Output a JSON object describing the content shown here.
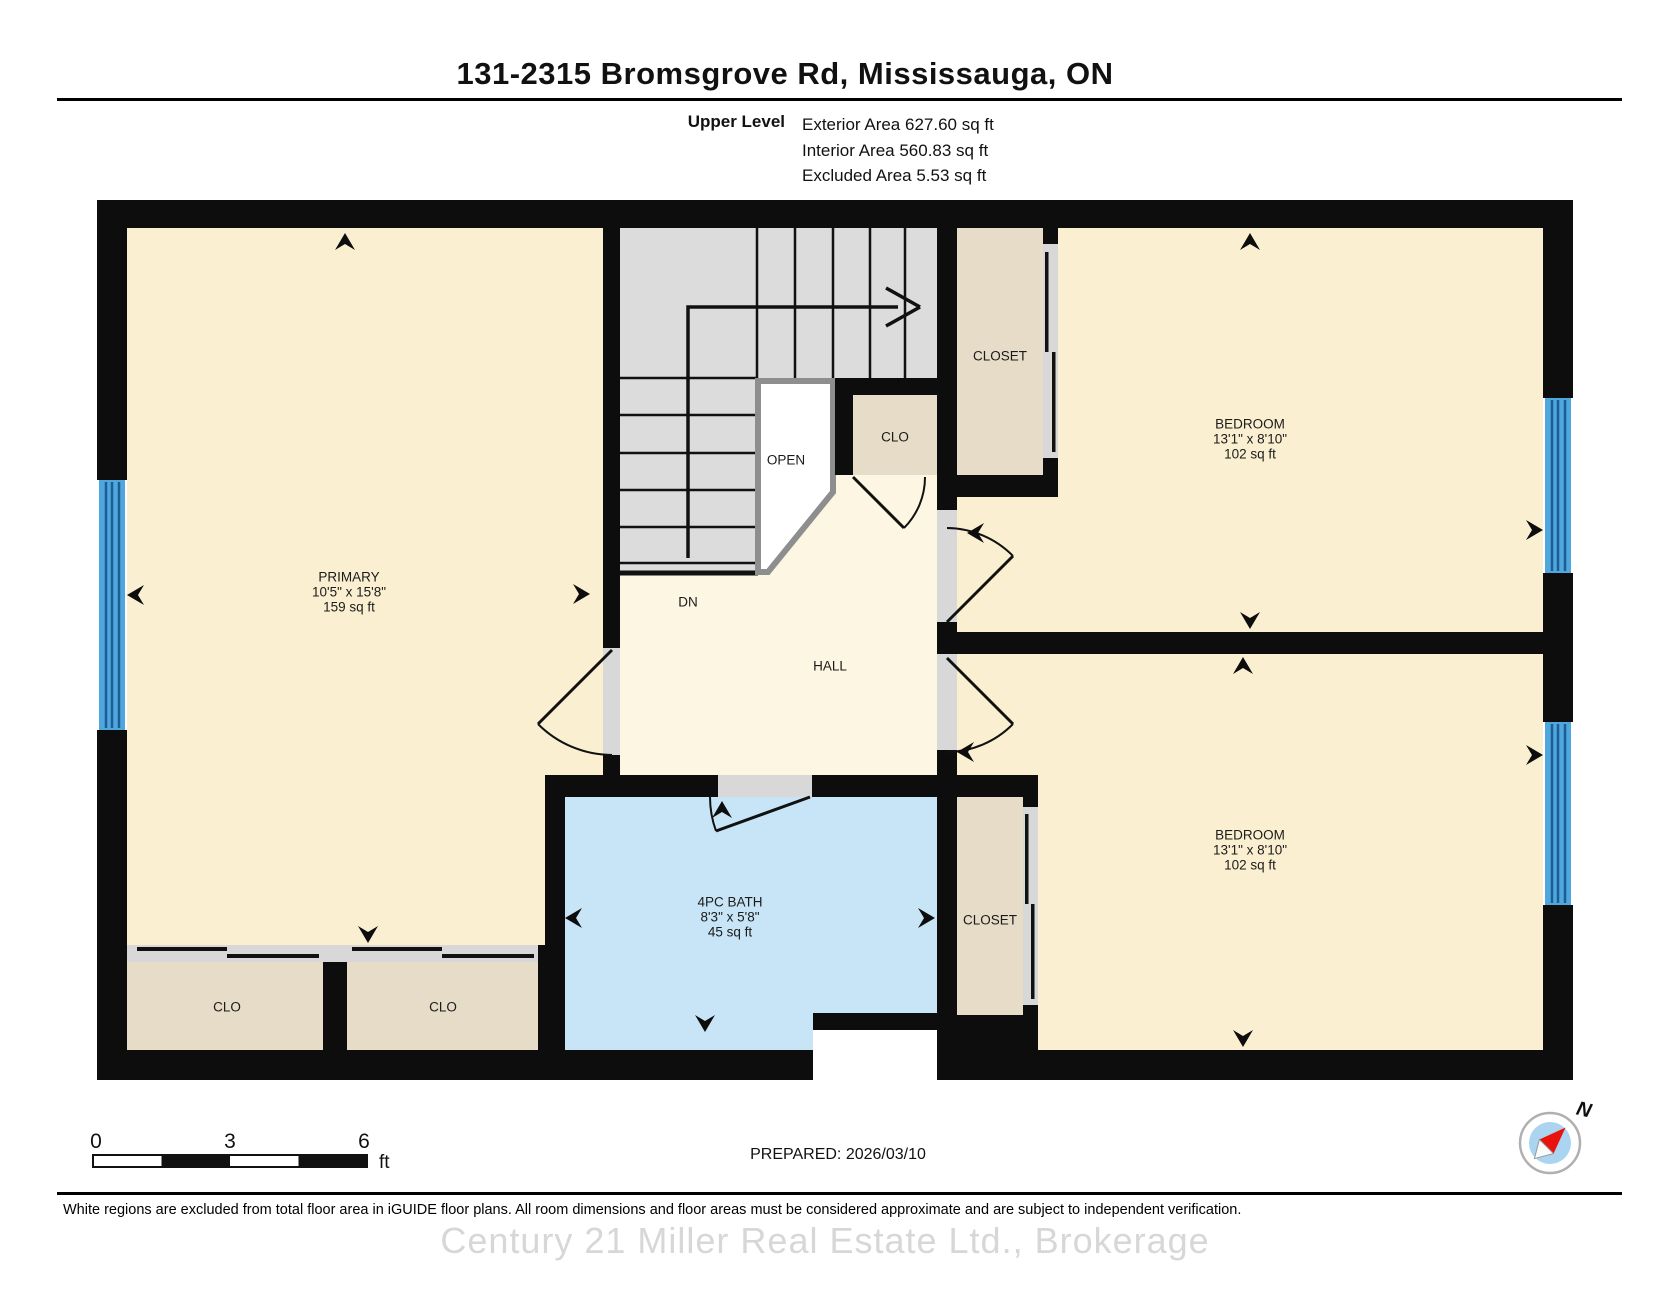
{
  "title": "131-2315 Bromsgrove Rd, Mississauga, ON",
  "level": {
    "name": "Upper Level",
    "exterior": "Exterior Area 627.60 sq ft",
    "interior": "Interior Area 560.83 sq ft",
    "excluded": "Excluded Area 5.53 sq ft"
  },
  "rooms": {
    "primary": {
      "name": "PRIMARY",
      "dims": "10'5\" x 15'8\"",
      "area": "159 sq ft"
    },
    "bedroom1": {
      "name": "BEDROOM",
      "dims": "13'1\" x 8'10\"",
      "area": "102 sq ft"
    },
    "bedroom2": {
      "name": "BEDROOM",
      "dims": "13'1\" x 8'10\"",
      "area": "102 sq ft"
    },
    "bath": {
      "name": "4PC BATH",
      "dims": "8'3\" x 5'8\"",
      "area": "45 sq ft"
    },
    "hall": {
      "name": "HALL"
    },
    "closet_top": {
      "name": "CLOSET"
    },
    "closet_bottom": {
      "name": "CLOSET"
    },
    "clo_hall": {
      "name": "CLO"
    },
    "clo_left": {
      "name": "CLO"
    },
    "clo_right": {
      "name": "CLO"
    },
    "open": {
      "name": "OPEN"
    },
    "down": {
      "name": "DN"
    }
  },
  "scale": {
    "ticks": [
      "0",
      "3",
      "6"
    ],
    "unit": "ft"
  },
  "prepared": "PREPARED: 2026/03/10",
  "compass": {
    "north_label": "N"
  },
  "disclaimer": "White regions are excluded from total floor area in iGUIDE floor plans. All room dimensions and floor areas must be considered approximate and are subject to independent verification.",
  "watermark": "Century 21 Miller Real Estate Ltd., Brokerage",
  "colors": {
    "wall": "#0d0d0d",
    "room_fill": "#faefd0",
    "hall_fill": "#fdf6e2",
    "closet_fill": "#e6dcc8",
    "stair_fill": "#dcdcdc",
    "bath_fill": "#c8e5f7",
    "window_blue": "#4fa7de",
    "window_line": "#1d5d94",
    "open_border": "#8e8e8e",
    "compass_inner": "#aad4f0",
    "compass_needle": "#e8130c"
  }
}
